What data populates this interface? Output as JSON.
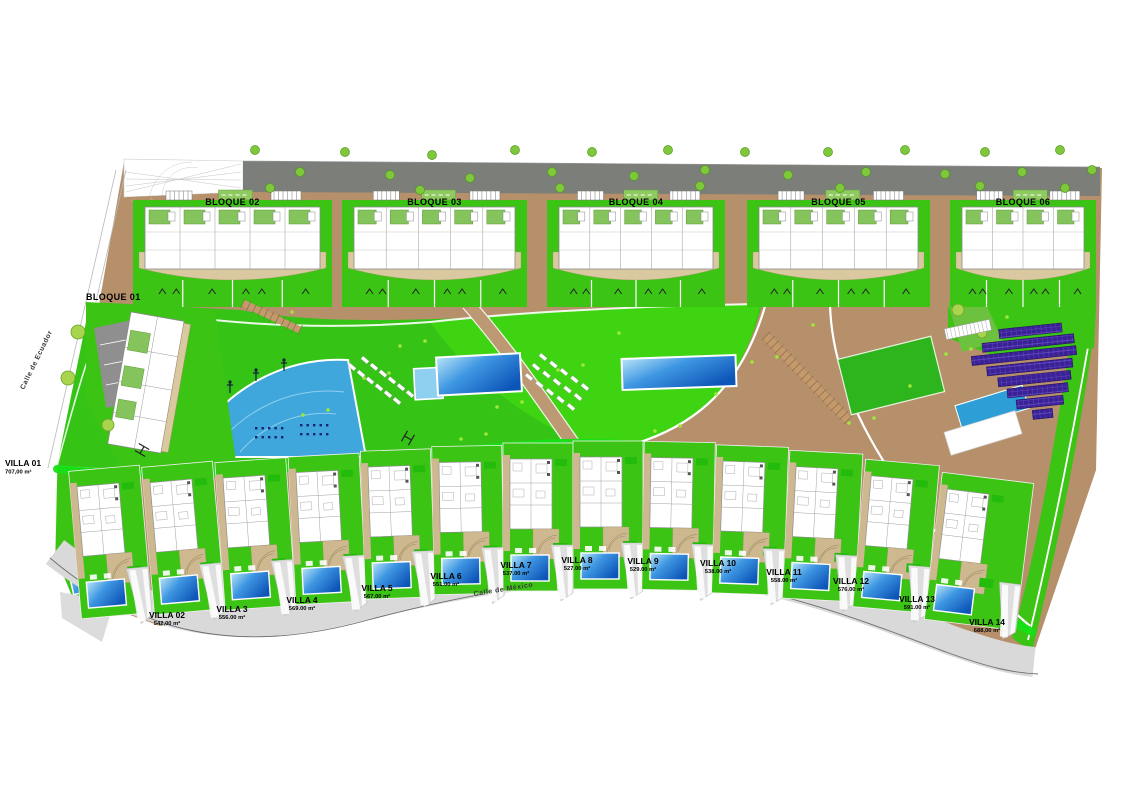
{
  "plan": {
    "title": "Residential development site plan",
    "streets": [
      {
        "name": "Calle de Ecuador"
      },
      {
        "name": "Calle de México"
      }
    ],
    "blocks": [
      {
        "label": "BLOQUE 01"
      },
      {
        "label": "BLOQUE 02"
      },
      {
        "label": "BLOQUE 03"
      },
      {
        "label": "BLOQUE 04"
      },
      {
        "label": "BLOQUE 05"
      },
      {
        "label": "BLOQUE 06"
      }
    ],
    "villas": [
      {
        "name": "VILLA 01",
        "area": "707,00 m²"
      },
      {
        "name": "VILLA 02",
        "area": "542,00 m²"
      },
      {
        "name": "VILLA 3",
        "area": "556.00 m²"
      },
      {
        "name": "VILLA 4",
        "area": "569.00 m²"
      },
      {
        "name": "VILLA 5",
        "area": "567.00 m²"
      },
      {
        "name": "VILLA 6",
        "area": "551.00 m²"
      },
      {
        "name": "VILLA 7",
        "area": "537.00 m²"
      },
      {
        "name": "VILLA 8",
        "area": "527.00 m²"
      },
      {
        "name": "VILLA 9",
        "area": "529.00 m²"
      },
      {
        "name": "VILLA 10",
        "area": "538.00 m²"
      },
      {
        "name": "VILLA 11",
        "area": "558.00 m²"
      },
      {
        "name": "VILLA 12",
        "area": "576.00 m²"
      },
      {
        "name": "VILLA 13",
        "area": "591.00 m²"
      },
      {
        "name": "VILLA 14",
        "area": "688,00 m²"
      }
    ],
    "colors": {
      "grass": "#35c316",
      "bright_path_green": "#15e015",
      "earth_brown": "#b5906b",
      "road_gray": "#7b7e79",
      "pool_dark_blue": "#0d55b8",
      "pool_light_blue": "#b9e4f8",
      "playground_blue": "#3fa7db",
      "solar_panel_purple": "#3a2195",
      "court_blue": "#2d9fd6",
      "plot_beige": "#cdb88f",
      "driveway_gray": "#d9d9d9",
      "tree_green": "#7fc83c"
    }
  }
}
